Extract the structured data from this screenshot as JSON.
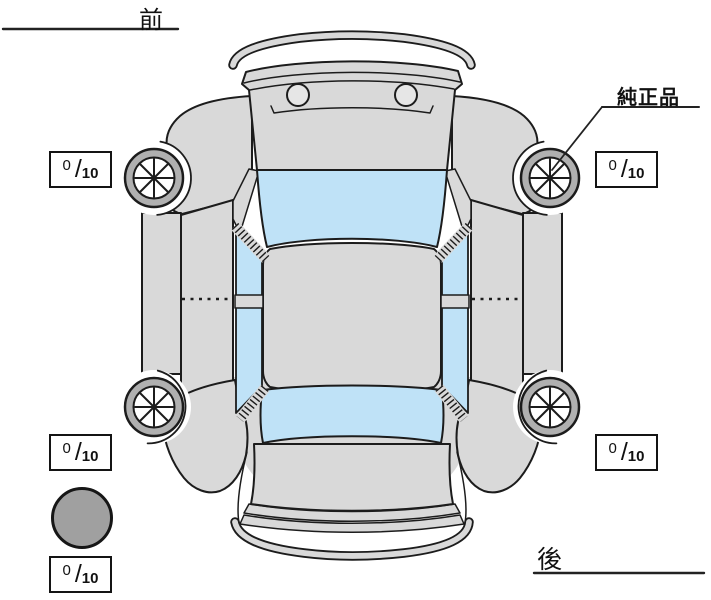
{
  "labels": {
    "front": "前",
    "rear": "後",
    "genuine_part": "純正品"
  },
  "tread": {
    "separator": "/",
    "front_left": {
      "value": "0",
      "max": "10"
    },
    "front_right": {
      "value": "0",
      "max": "10"
    },
    "rear_left": {
      "value": "0",
      "max": "10"
    },
    "rear_right": {
      "value": "0",
      "max": "10"
    },
    "spare": {
      "value": "0",
      "max": "10"
    }
  },
  "icons": {
    "wheel": "wheel-spoke-icon",
    "spare": "spare-tire-icon"
  },
  "colors": {
    "body": "#d9d9d9",
    "window": "#bfe2f7",
    "tire": "#b0b0b0",
    "outline": "#1c1c1c",
    "spare_circle": "#a0a0a0",
    "background": "#ffffff"
  }
}
